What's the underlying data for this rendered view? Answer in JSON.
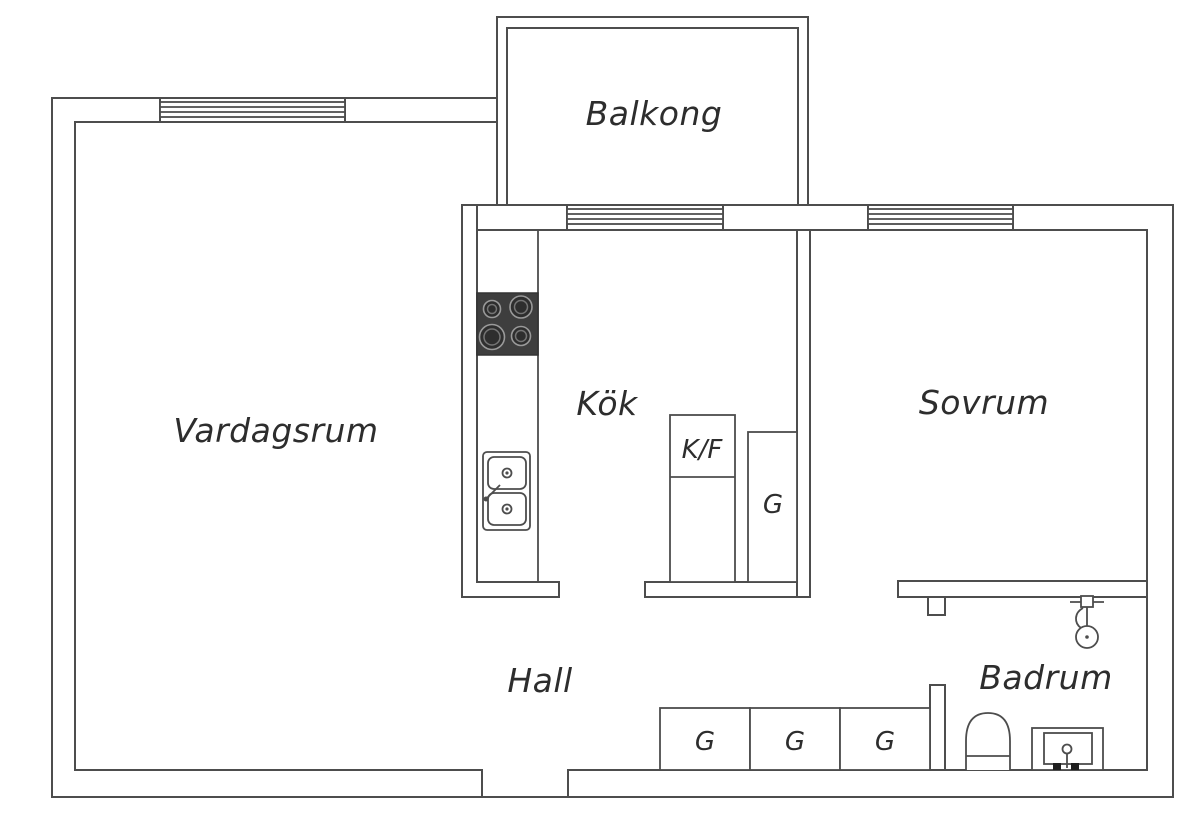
{
  "title": "Apartment floor plan",
  "colors": {
    "wall_line": "#4d4d4d",
    "text": "#2d2d2d",
    "stove": "#3e3e3e",
    "background": "#ffffff"
  },
  "rooms": {
    "balcony": {
      "label": "Balkong"
    },
    "living_room": {
      "label": "Vardagsrum"
    },
    "kitchen": {
      "label": "Kök"
    },
    "bedroom": {
      "label": "Sovrum"
    },
    "hall": {
      "label": "Hall"
    },
    "bathroom": {
      "label": "Badrum"
    }
  },
  "storage": {
    "fridge_freezer_label": "K/F",
    "wardrobe_label": "G",
    "kitchen_wardrobe_count": 1,
    "hall_wardrobe_count": 3
  },
  "fixtures": [
    "stove",
    "kitchen-sink",
    "shower",
    "toilet",
    "bathroom-sink"
  ],
  "windows": [
    "living-room-window",
    "kitchen-window",
    "bedroom-window"
  ]
}
